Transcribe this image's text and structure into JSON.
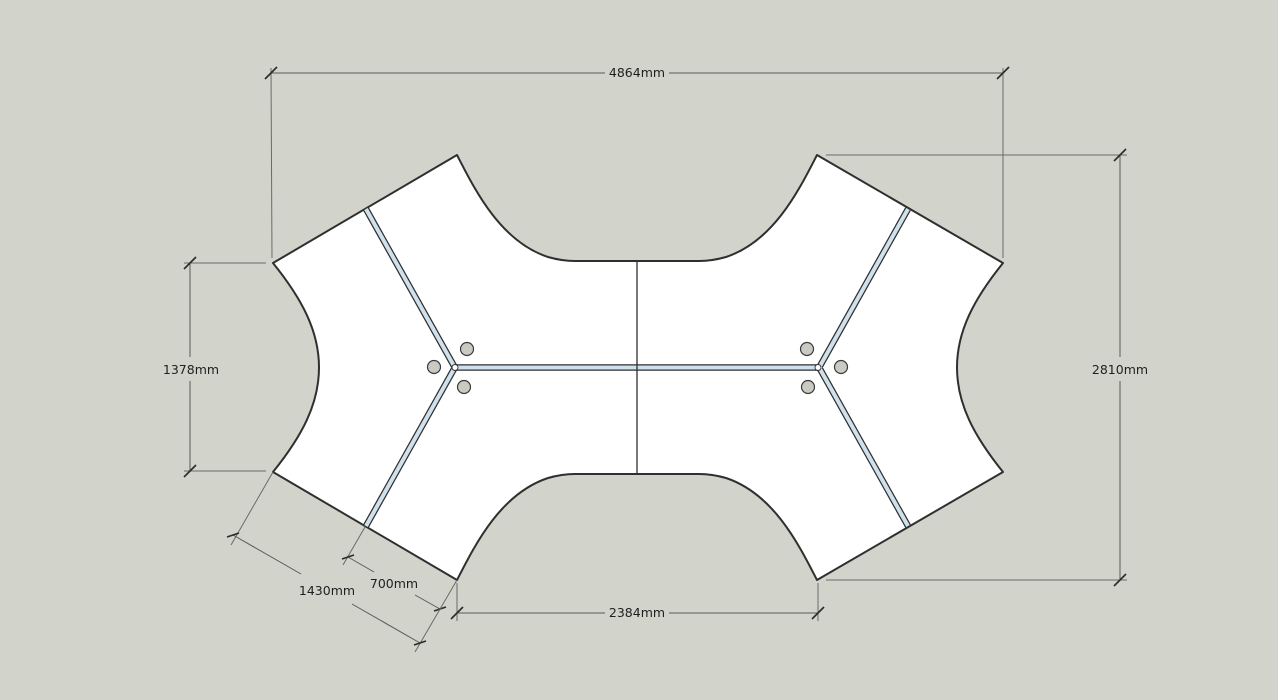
{
  "drawing": {
    "type": "desk-cluster-floor-plan",
    "units": "mm",
    "dimensions": {
      "top_overall_width": {
        "label": "4864mm"
      },
      "left_desk_height": {
        "label": "1378mm"
      },
      "right_overall_height": {
        "label": "2810mm"
      },
      "bottom_inner_width": {
        "label": "2384mm"
      },
      "desk_end_width": {
        "label": "700mm"
      },
      "corner_span": {
        "label": "1430mm"
      }
    },
    "features": {
      "clusters": 2,
      "desks_per_cluster": 3,
      "grommets_per_cluster": 3
    },
    "colors": {
      "background": "#d2d4cb",
      "desk_fill": "#ffffff",
      "edge": "#2f2f2f",
      "divider_fill": "#cfe1ec",
      "grommet_fill": "#c9cbc3",
      "dimension_line": "#5a5a5a",
      "dimension_text": "#1f1f1f"
    }
  }
}
